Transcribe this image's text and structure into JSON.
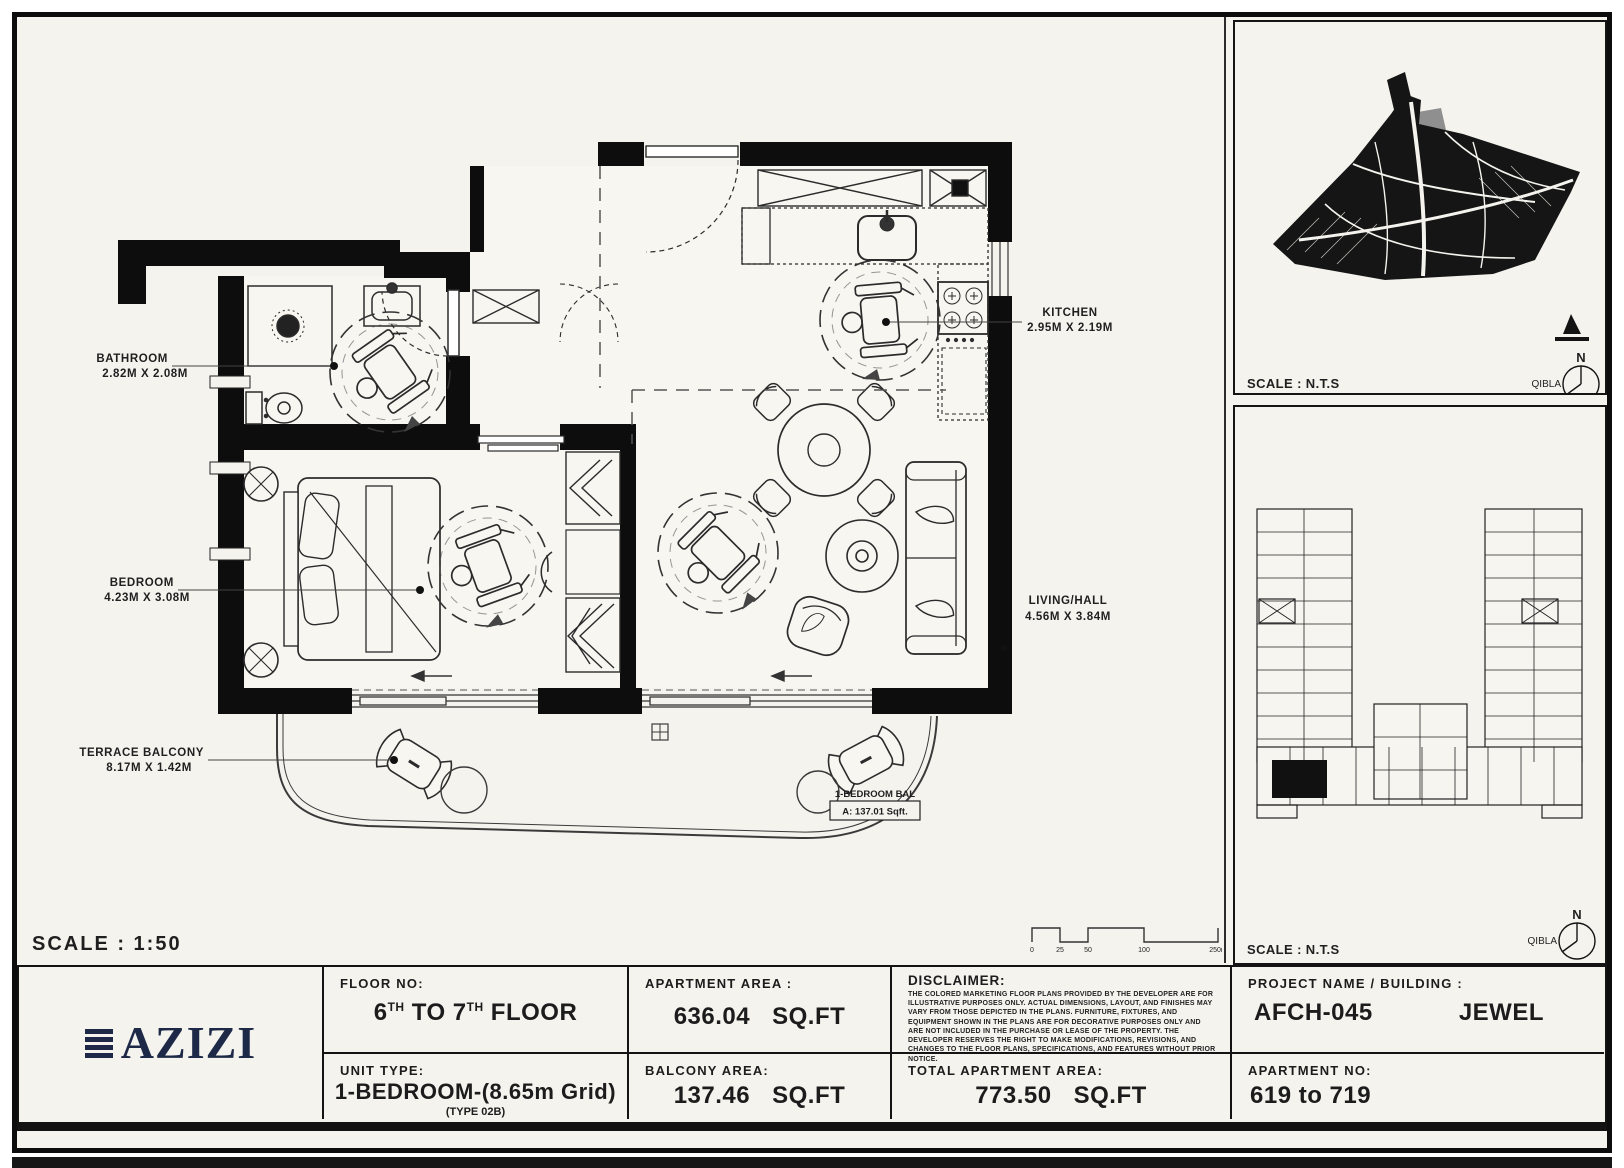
{
  "main_plan": {
    "scale_text": "SCALE : 1:50",
    "labels": {
      "bathroom": {
        "name": "BATHROOM",
        "dims": "2.82M X 2.08M"
      },
      "bedroom": {
        "name": "BEDROOM",
        "dims": "4.23M X 3.08M"
      },
      "kitchen": {
        "name": "KITCHEN",
        "dims": "2.95M X 2.19M"
      },
      "living": {
        "name": "LIVING/HALL",
        "dims": "4.56M X 3.84M"
      },
      "terrace": {
        "name": "TERRACE BALCONY",
        "dims": "8.17M X 1.42M"
      }
    },
    "balcony_tag": {
      "title": "1-BEDROOM BAL",
      "area": "A: 137.01 Sqft."
    },
    "scale_bar_ticks": [
      "0",
      "25",
      "50",
      "100",
      "250m"
    ]
  },
  "site_panel": {
    "scale_text": "SCALE : N.T.S",
    "north_label": "N",
    "qibla_label": "QIBLA"
  },
  "key_panel": {
    "scale_text": "SCALE : N.T.S",
    "north_label": "N",
    "qibla_label": "QIBLA"
  },
  "title_block": {
    "brand": "AZIZI",
    "floor_no": {
      "label": "FLOOR NO:",
      "v1": "6",
      "s1": "TH",
      "v2": " TO 7",
      "s2": "TH",
      "v3": " FLOOR"
    },
    "unit_type": {
      "label": "UNIT TYPE:",
      "value": "1-BEDROOM-(8.65m Grid)",
      "subvalue": "(TYPE 02B)"
    },
    "apartment_area": {
      "label": "APARTMENT AREA :",
      "value": "636.04",
      "unit": "SQ.FT"
    },
    "balcony_area": {
      "label": "BALCONY AREA:",
      "value": "137.46",
      "unit": "SQ.FT"
    },
    "disclaimer": {
      "label": "DISCLAIMER:",
      "text": "THE COLORED MARKETING FLOOR PLANS PROVIDED BY THE DEVELOPER ARE FOR ILLUSTRATIVE PURPOSES ONLY. ACTUAL DIMENSIONS, LAYOUT, AND FINISHES MAY VARY FROM THOSE DEPICTED IN THE PLANS. FURNITURE, FIXTURES, AND EQUIPMENT SHOWN IN THE PLANS ARE FOR DECORATIVE PURPOSES ONLY AND ARE NOT INCLUDED IN THE PURCHASE OR LEASE OF THE PROPERTY. THE DEVELOPER RESERVES THE RIGHT TO MAKE MODIFICATIONS, REVISIONS, AND CHANGES TO THE FLOOR PLANS, SPECIFICATIONS, AND FEATURES WITHOUT PRIOR NOTICE."
    },
    "total_area": {
      "label": "TOTAL APARTMENT AREA:",
      "value": "773.50",
      "unit": "SQ.FT"
    },
    "project": {
      "label": "PROJECT NAME / BUILDING :",
      "code": "AFCH-045",
      "name": "JEWEL"
    },
    "apartment_no": {
      "label": "APARTMENT NO:",
      "value": "619 to 719"
    }
  },
  "colors": {
    "background": "#f4f3ee",
    "ink": "#111111",
    "brand_navy": "#1d2947"
  }
}
